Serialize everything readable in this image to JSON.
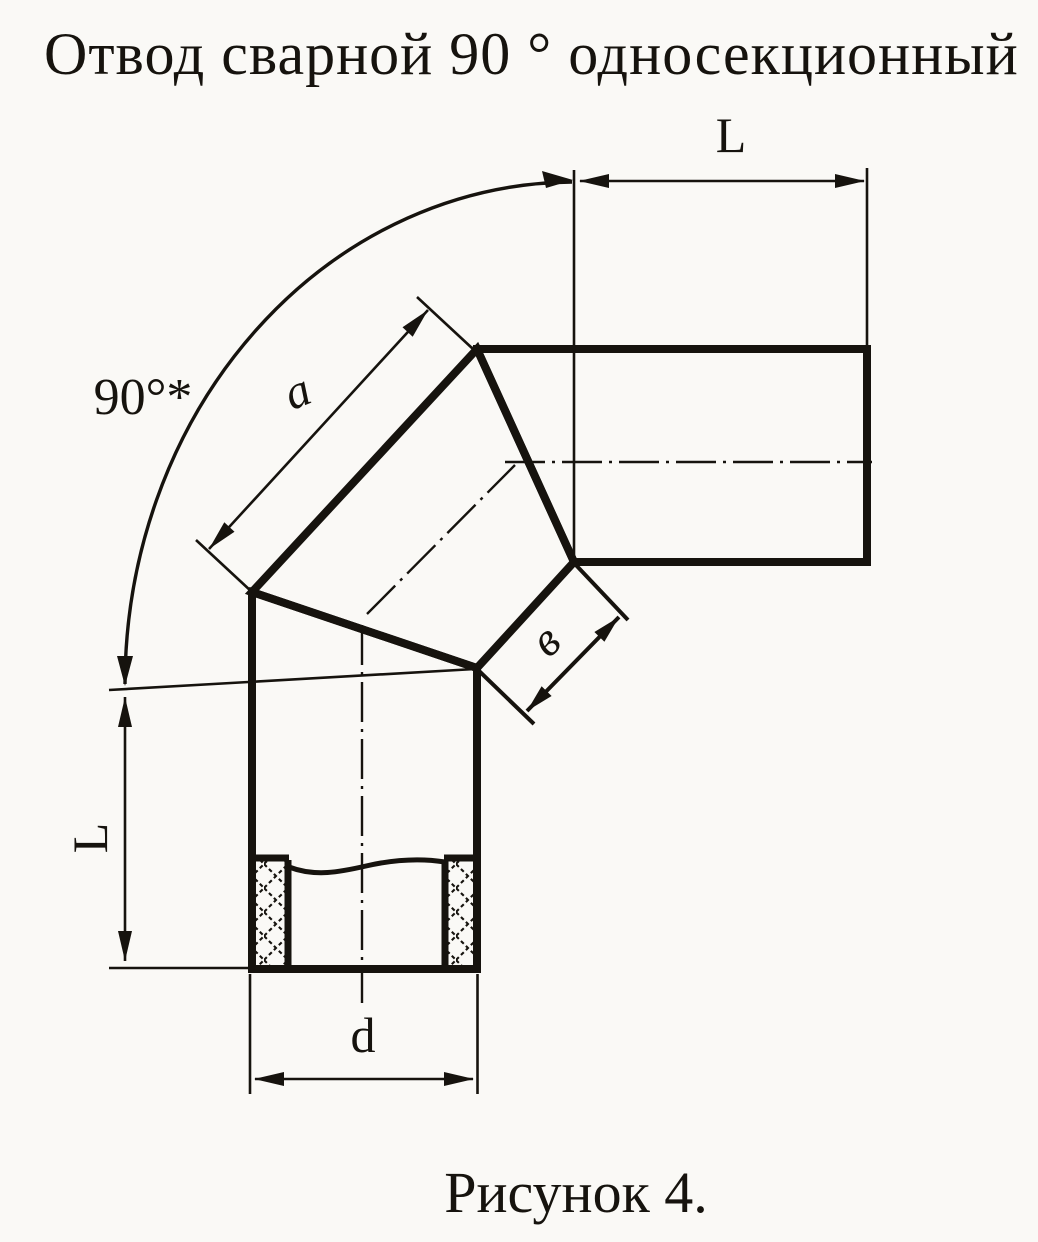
{
  "page": {
    "background_color": "#faf9f6",
    "ink_color": "#16130e"
  },
  "title": {
    "text": "Отвод сварной 90 ° односекционный"
  },
  "caption": {
    "text": "Рисунок 4."
  },
  "dimensions": {
    "angle": {
      "label": "90°*",
      "meaning": "elbow angle with tolerance note"
    },
    "top_length": {
      "label": "L",
      "meaning": "straight length of horizontal pipe end"
    },
    "left_length": {
      "label": "L",
      "meaning": "straight length of vertical pipe end"
    },
    "gore_side": {
      "label": "a",
      "meaning": "outer side length of middle gore section"
    },
    "gore_end_width": {
      "label": "в",
      "meaning": "width of gore end face"
    },
    "diameter": {
      "label": "d",
      "meaning": "pipe outside diameter"
    }
  }
}
